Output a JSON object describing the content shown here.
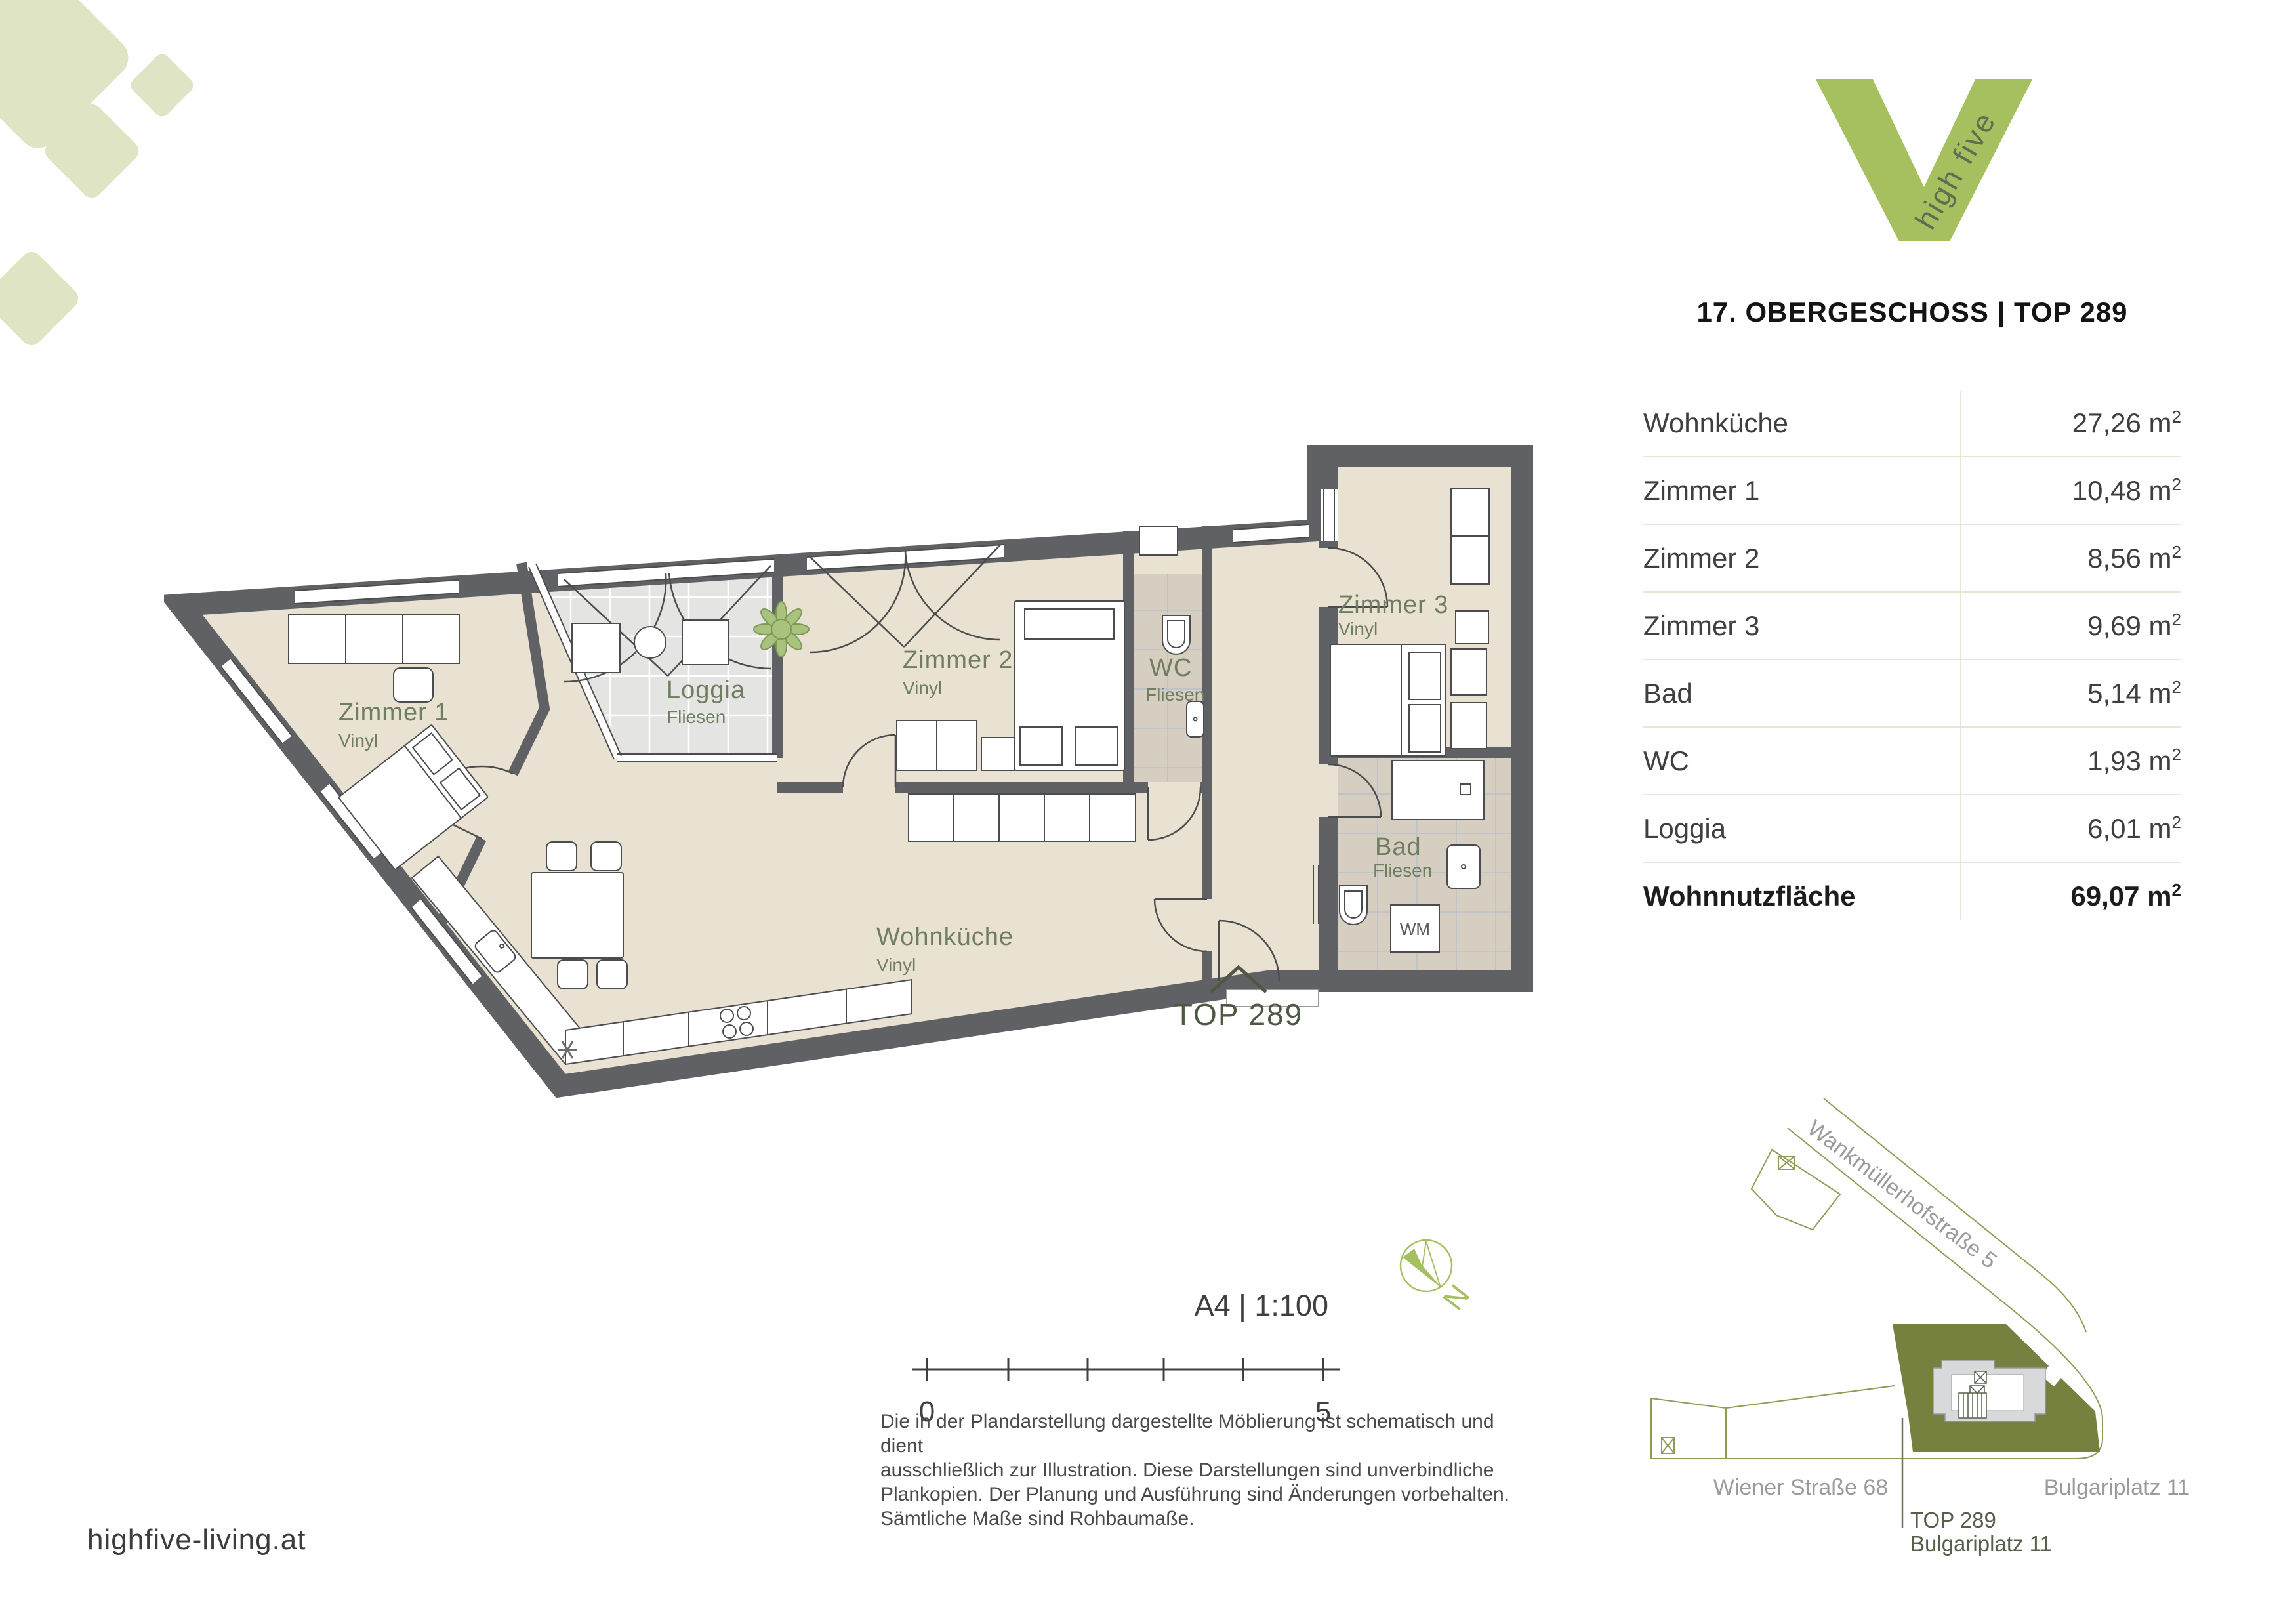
{
  "logo": {
    "tagline": "high five",
    "brand_color": "#a7c05f",
    "tagline_color": "#5e6e51"
  },
  "header": {
    "title": "17. OBERGESCHOSS | TOP 289"
  },
  "area_table": {
    "sup": "2",
    "divider_color": "#e3e8d2",
    "rows": [
      {
        "label": "Wohnküche",
        "area": "27,26 m"
      },
      {
        "label": "Zimmer 1",
        "area": "10,48 m"
      },
      {
        "label": "Zimmer 2",
        "area": "8,56 m"
      },
      {
        "label": "Zimmer 3",
        "area": "9,69 m"
      },
      {
        "label": "Bad",
        "area": "5,14 m"
      },
      {
        "label": "WC",
        "area": "1,93 m"
      },
      {
        "label": "Loggia",
        "area": "6,01 m"
      },
      {
        "label": "Wohnnutzfläche",
        "area": "69,07 m"
      }
    ]
  },
  "plan": {
    "unit_label": "TOP 289",
    "rooms": [
      {
        "name": "Zimmer 1",
        "floor": "Vinyl"
      },
      {
        "name": "Loggia",
        "floor": "Fliesen"
      },
      {
        "name": "Zimmer 2",
        "floor": "Vinyl"
      },
      {
        "name": "WC",
        "floor": "Fliesen"
      },
      {
        "name": "Zimmer 3",
        "floor": "Vinyl"
      },
      {
        "name": "Wohnküche",
        "floor": "Vinyl"
      },
      {
        "name": "Bad",
        "floor": "Fliesen"
      }
    ],
    "appliances": {
      "washing_machine": "WM"
    },
    "colors": {
      "wall": "#606164",
      "floor": "#e9e1d2",
      "tile_warm": "#d6cec1",
      "tile_cool": "#e4e5e3",
      "label": "#6f7d60"
    }
  },
  "scalebar": {
    "label": "A4 | 1:100",
    "start": "0",
    "end": "5"
  },
  "north": {
    "label": "N"
  },
  "disclaimer": {
    "lines": [
      "Die in der Plandarstellung dargestellte Möblierung ist schematisch und dient",
      "ausschließlich zur Illustration. Diese Darstellungen sind unverbindliche",
      "Plankopien. Der Planung und Ausführung sind Änderungen vorbehalten.",
      "Sämtliche Maße sind Rohbaumaße."
    ]
  },
  "footer": {
    "website": "highfive-living.at"
  },
  "siteplan": {
    "streets": [
      "Wankmüllerhofstraße 5",
      "Wiener Straße 68",
      "Bulgariplatz 11"
    ],
    "callout": {
      "line1": "TOP 289",
      "line2": "Bulgariplatz 11"
    },
    "highlight_color": "#77813f"
  }
}
